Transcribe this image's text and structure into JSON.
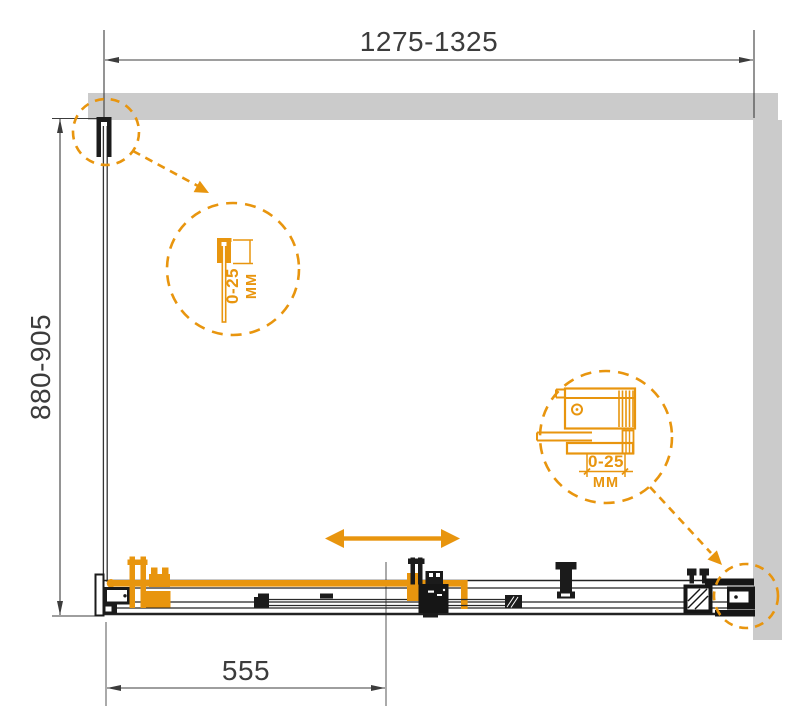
{
  "dimensions": {
    "overall_width": "1275-1325",
    "side_depth": "880-905",
    "door_offset": "555"
  },
  "detail_callouts": {
    "wall_profile": {
      "adjustment": "0-25",
      "unit": "MM"
    },
    "wall_bracket": {
      "adjustment": "0-25",
      "unit": "MM"
    }
  },
  "colors": {
    "accent_orange": "#E8950E",
    "wall_gray": "#CBCBCB",
    "drawing_black": "#1B1B1B",
    "dimension_gray": "#3C3C3C",
    "background": "#FFFFFF"
  },
  "icons": {
    "slide_direction_arrow": "double-headed-arrow"
  }
}
